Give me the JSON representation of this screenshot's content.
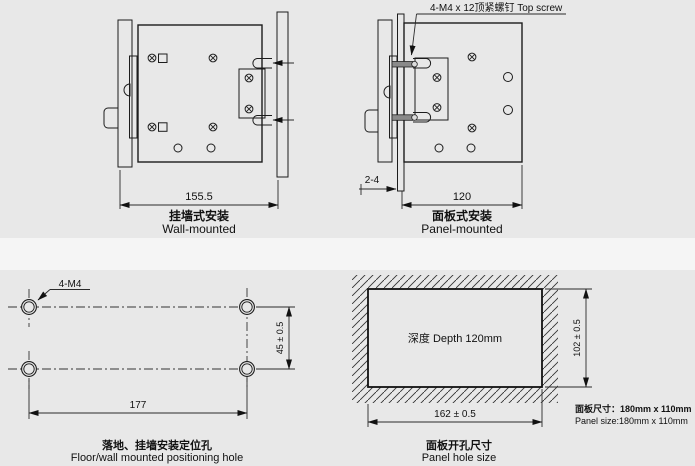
{
  "top_left": {
    "dim_width": "155.5",
    "label_zh": "挂墙式安装",
    "label_en": "Wall-mounted"
  },
  "top_right": {
    "callout": "4-M4 x 12顶紧螺钉 Top screw",
    "dim_panel_thickness": "2-4",
    "dim_depth": "120",
    "label_zh": "面板式安装",
    "label_en": "Panel-mounted"
  },
  "bottom_left": {
    "callout": "4-M4",
    "dim_vertical": "45 ± 0.5",
    "dim_horizontal": "177",
    "label_zh": "落地、挂墙安装定位孔",
    "label_en": "Floor/wall mounted positioning hole"
  },
  "bottom_right": {
    "depth_note": "深度 Depth 120mm",
    "dim_vertical": "102 ± 0.5",
    "dim_horizontal": "162 ± 0.5",
    "panel_size_zh": "面板尺寸：180mm x 110mm",
    "panel_size_en": "Panel size:180mm x 110mm",
    "label_zh": "面板开孔尺寸",
    "label_en": "Panel hole size"
  },
  "colors": {
    "background_panel": "#e8e8e8",
    "background_gap": "#f5f5f5",
    "line": "#1c1c1c"
  }
}
